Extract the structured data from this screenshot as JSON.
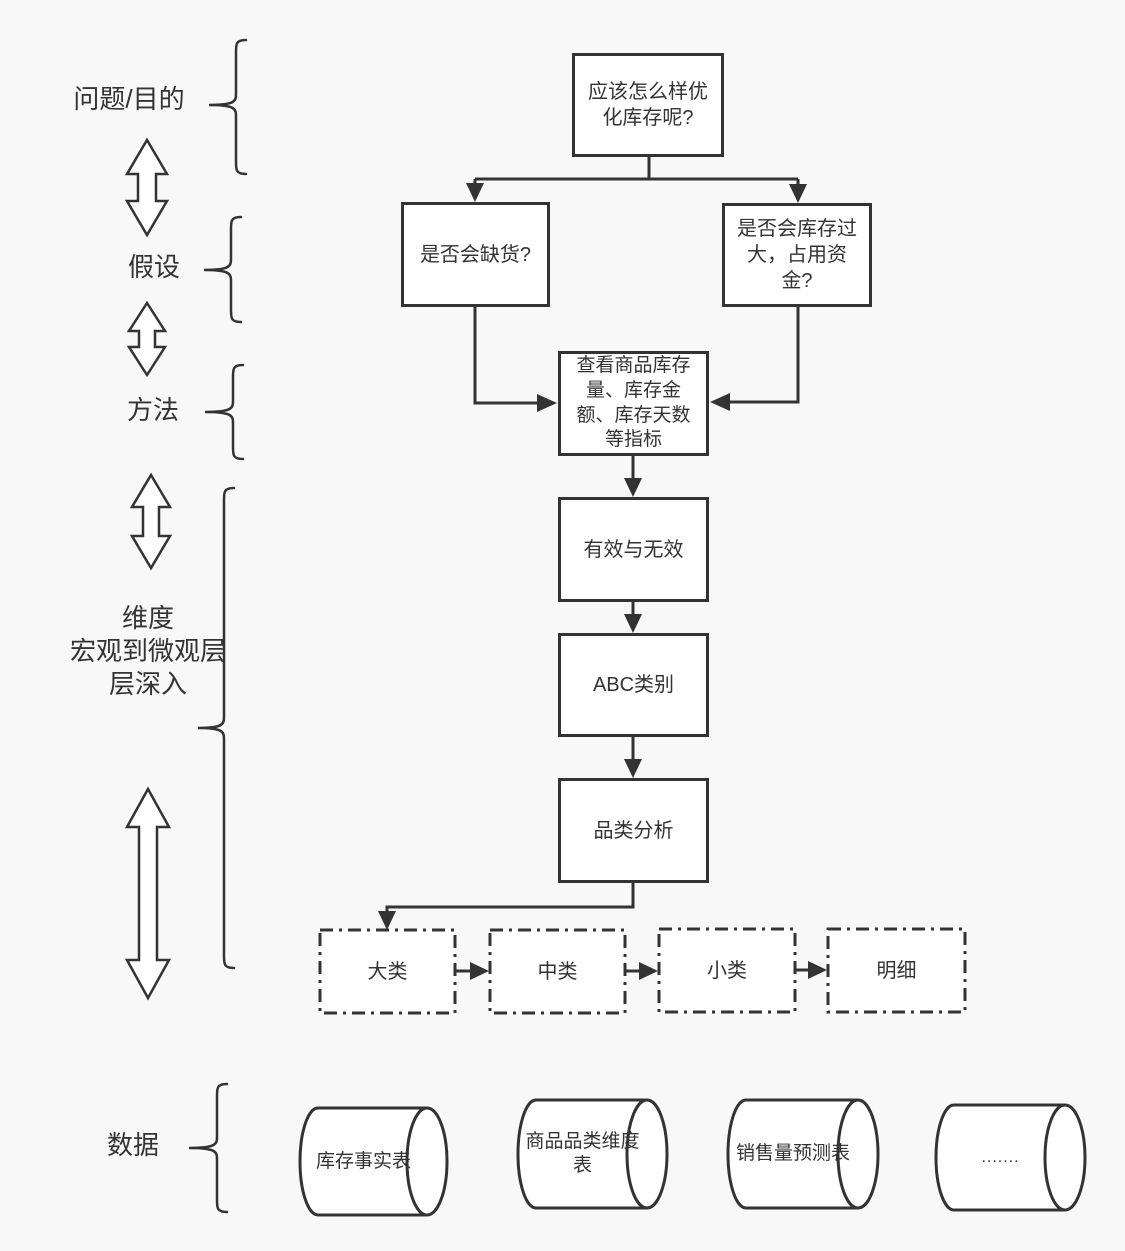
{
  "colors": {
    "background": "#f8f8f8",
    "stroke": "#333333",
    "node_fill": "#ffffff",
    "text": "#333333"
  },
  "row_labels": {
    "problem": "问题/目的",
    "hypothesis": "假设",
    "method": "方法",
    "dimension": "维度\n宏观到微观层\n层深入",
    "data": "数据"
  },
  "flow_nodes": {
    "question": "应该怎么样优\n化库存呢?",
    "shortage": "是否会缺货?",
    "overstock": "是否会库存过\n大，占用资\n金?",
    "metrics": "查看商品库存\n量、库存金\n额、库存天数\n等指标",
    "valid_invalid": "有效与无效",
    "abc": "ABC类别",
    "category_analysis": "品类分析"
  },
  "category_levels": {
    "major": "大类",
    "middle": "中类",
    "minor": "小类",
    "detail": "明细"
  },
  "data_tables": {
    "inventory_fact": "库存事实表",
    "category_dimension": "商品品类维度\n表",
    "sales_forecast": "销售量预测表",
    "more": "......."
  }
}
